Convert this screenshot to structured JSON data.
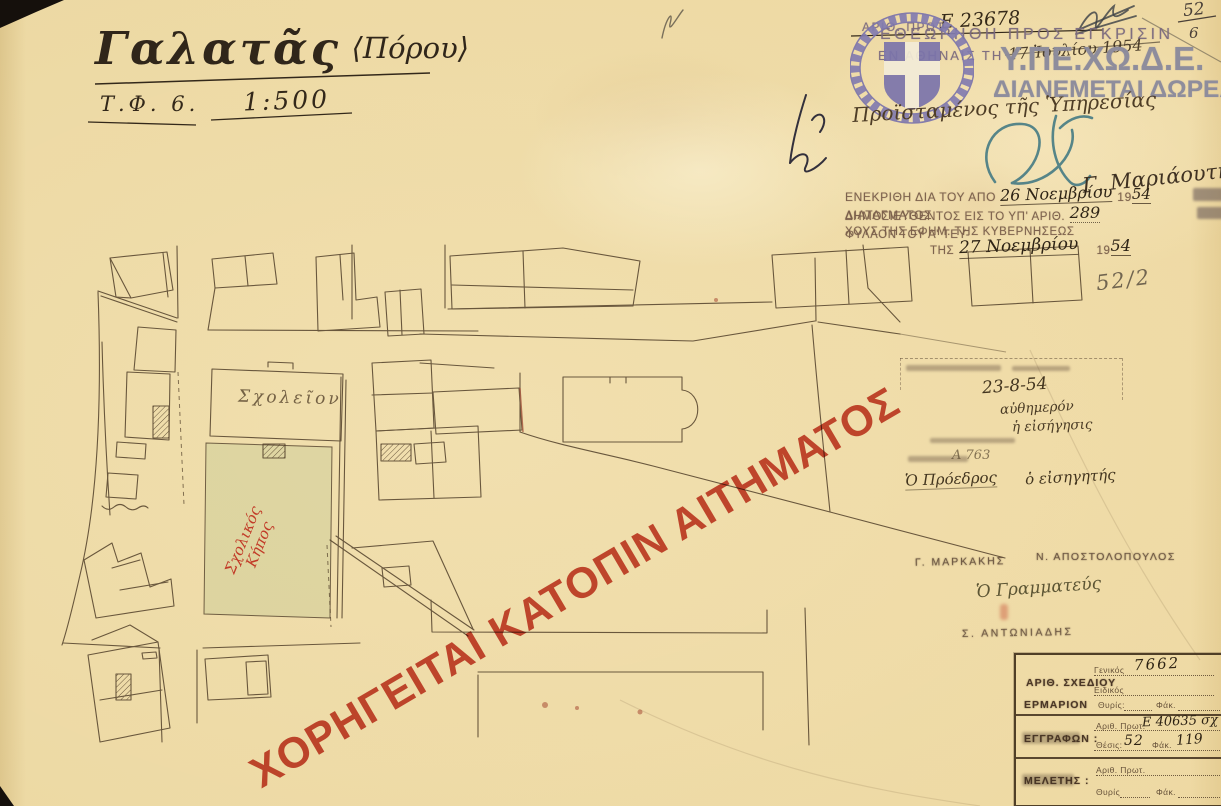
{
  "document": {
    "title": "Γαλατᾶς",
    "title_suffix": "⟨Πόρου⟩",
    "sheet_ref": "Τ.Φ. 6.",
    "scale": "1:500"
  },
  "protocol_line": {
    "label": "ΑΡΙΘ. ΠΡΩΤ.",
    "number": "Ε 23678",
    "corner_fraction_top": "52",
    "corner_fraction_bottom": "6"
  },
  "review_stamp": {
    "line1": "ΕΘΕΩΡΗΘΗ ΠΡΟΣ ΕΓΚΡΙΣΙΝ",
    "line2_label": "ΕΝ ΑΘΗΝΑΙΣ ΤΗ",
    "line2_date": "17 Ἰουλίου 1954"
  },
  "ministry_overprint": {
    "acronym": "Υ.ΠΕ.ΧΩ.Δ.Ε.",
    "line2": "ΔΙΑΝΕΜΕΤΑΙ ΔΩΡΕΑΝ"
  },
  "signatures": {
    "service_head_label": "Προϊσταμένος τῆς Ὑπηρεσίας",
    "approver_name": "Γ. Μαριάουτη"
  },
  "approval_stamp": {
    "l1_a": "ΕΝΕΚΡΙΘΗ ΔΙΑ ΤΟΥ ΑΠΟ",
    "l1_date": "26 Νοεμβρίου",
    "l1_b": "19",
    "l1_year": "54",
    "l1_c": "ΔΙΑΤΑΓΜΑΤΟΣ",
    "l2_a": "ΔΗΜΟΣΙΕΥΘΕΝΤΟΣ ΕΙΣ ΤΟ ΥΠ' ΑΡΙΘ.",
    "l2_num": "289",
    "l2_b": "ΦΥΛΛΟΝ ΤΟΥ Α' ΤΕΥ-",
    "l3": "ΧΟΥΣ ΤΗΣ ΕΦΗΜ. ΤΗΣ ΚΥΒΕΡΝΗΣΕΩΣ",
    "l4_a": "ΤΗΣ",
    "l4_date": "27 Νοεμβρίου",
    "l4_b": "19",
    "l4_year": "54"
  },
  "pencil_notes": {
    "fraction_note": "52/2"
  },
  "council_stamp": {
    "date": "23-8-54",
    "note1": "αὐθημερόν",
    "note2": "ἡ εἰσήγησις",
    "ref_number": "Α 763",
    "president_label": "Ὁ Πρόεδρος",
    "rapporteur_label": "ὁ εἰσηγητής"
  },
  "committee": {
    "member1": "Γ. ΜΑΡΚΑΚΗΣ",
    "member2": "Ν. ΑΠΟΣΤΟΛΟΠΟΥΛΟΣ",
    "secretary_label": "Ὁ Γραμματεύς",
    "secretary_name": "Σ. ΑΝΤΩΝΙΑΔΗΣ"
  },
  "archive_box": {
    "row1_label": "ΑΡΙΘ. ΣΧΕΔΙΟΥ",
    "row1_f1_label": "Γενικός",
    "row1_f1_value": "7662",
    "row1_f2_label": "Ειδικός",
    "row2_label": "ΕΡΜΑΡΙΟΝ",
    "row2_f1_label": "Θυρίς:",
    "row2_f2_label": "Φάκ.",
    "row3_label": "ΕΓΓΡΑΦΩΝ :",
    "row3_f1_label": "Αριθ. Πρωτ.",
    "row3_f1_value": "Ε 40635 σχ",
    "row3_f2_label": "Θέσις:",
    "row3_f2_value": "52",
    "row3_f3_label": "Φάκ.",
    "row3_f3_value": "119",
    "row4_label": "ΜΕΛΕΤΗΣ :",
    "row4_f1_label": "Αριθ. Πρωτ.",
    "row4_f2_label": "Θυρίς",
    "row4_f3_label": "Φάκ."
  },
  "map_labels": {
    "school": "Σχολεῖον",
    "garden_line1": "Σχολικός",
    "garden_line2": "Κήπος"
  },
  "watermark": {
    "text": "ΧΟΡΗΓΕΙΤΑΙ ΚΑΤΟΠΙΝ ΑΙΤΗΜΑΤΟΣ"
  },
  "colors": {
    "paper": "#eed9a3",
    "plan_ink": "#52402a",
    "watermark_red": "#c1301e",
    "ministry_blue": "#7b74ab",
    "overprint_gray": "#8c8b9c",
    "stamp_purple": "#7b6a7e",
    "teal_signature": "#467b84"
  }
}
